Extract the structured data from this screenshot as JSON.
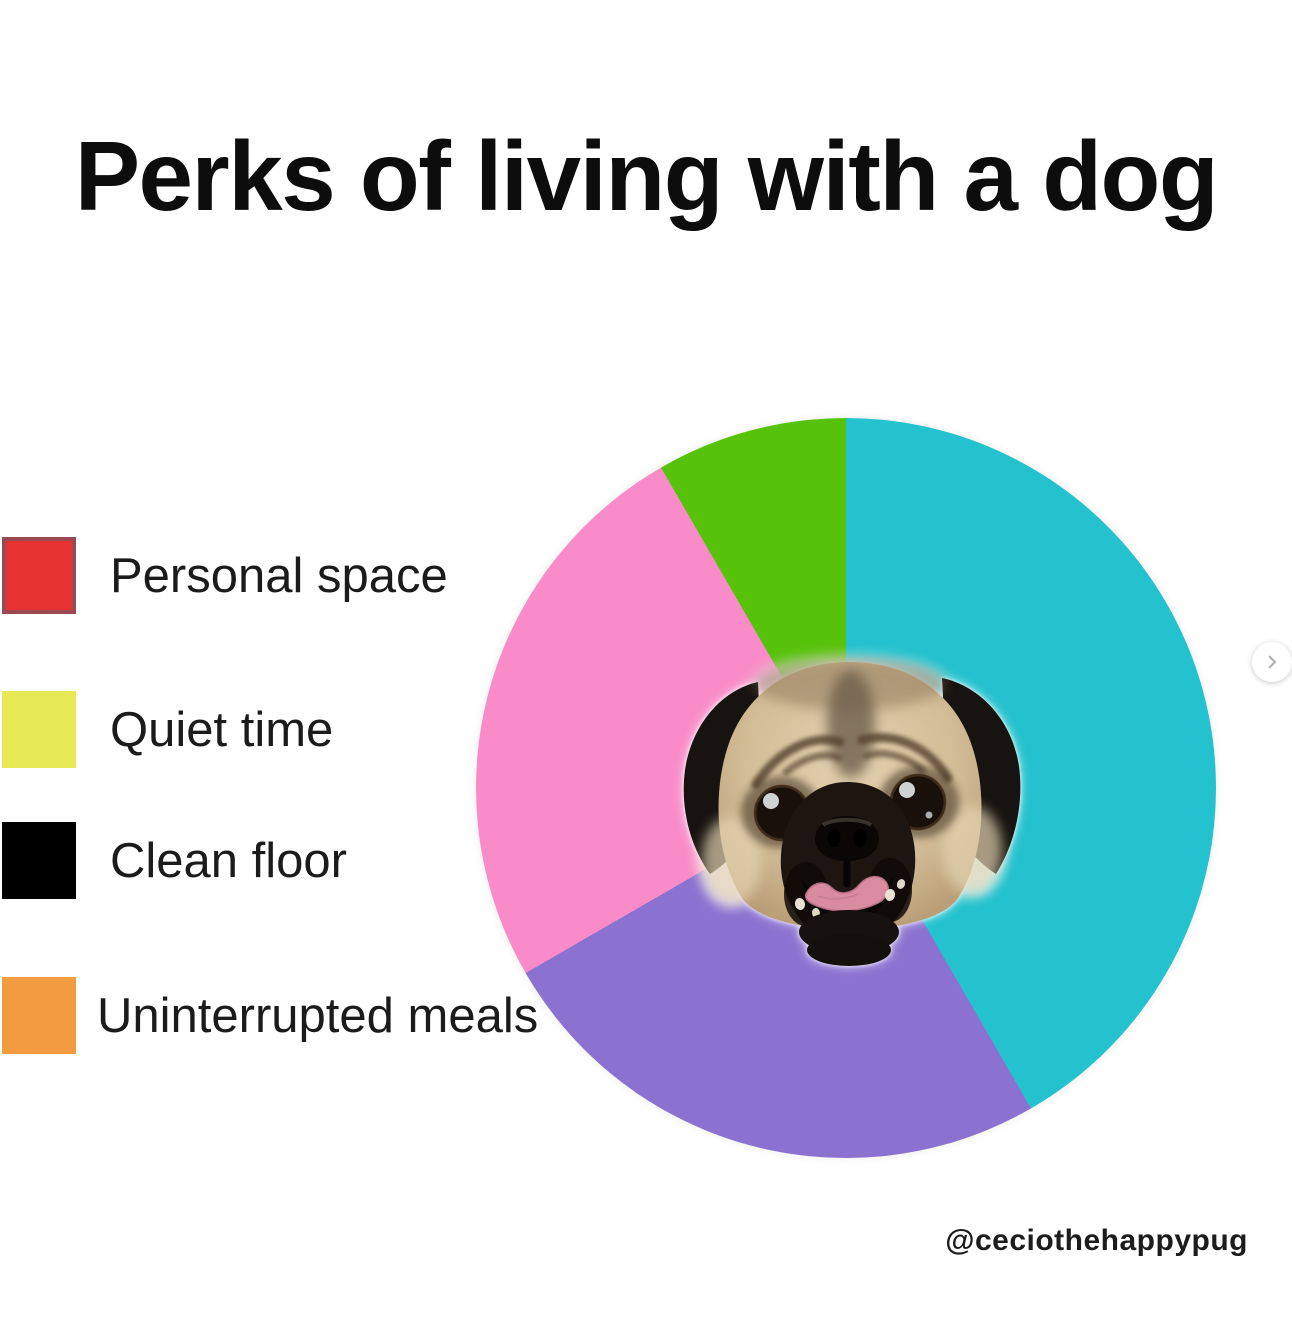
{
  "title": "Perks of living with a dog",
  "legend": {
    "items": [
      {
        "label": "Personal space",
        "color": "#e63230",
        "border": "#9c4a52"
      },
      {
        "label": "Quiet time",
        "color": "#e6e954",
        "border": null
      },
      {
        "label": "Clean floor",
        "color": "#000000",
        "border": null
      },
      {
        "label": "Uninterrupted meals",
        "color": "#f29b41",
        "border": null
      }
    ]
  },
  "chart_data": {
    "type": "pie",
    "title": "Perks of living with a dog",
    "legend_entries": [
      "Personal space",
      "Quiet time",
      "Clean floor",
      "Uninterrupted meals"
    ],
    "legend_colors": [
      "#e63230",
      "#e6e954",
      "#000000",
      "#f29b41"
    ],
    "slices": [
      {
        "name": "teal",
        "hex": "#23c2ce",
        "degrees": 150,
        "percent": 41.7
      },
      {
        "name": "purple",
        "hex": "#8b72d0",
        "degrees": 90,
        "percent": 25
      },
      {
        "name": "pink",
        "hex": "#f98cc8",
        "degrees": 90,
        "percent": 25
      },
      {
        "name": "green",
        "hex": "#57c20a",
        "degrees": 30,
        "percent": 8.3
      }
    ],
    "start_angle_deg": 0,
    "direction": "clockwise",
    "center_image": "pug face photo cutout",
    "annotation": "No pie slice color matches any legend entry color"
  },
  "watermark": "@ceciothehappypug",
  "carousel": {
    "next_icon": "chevron-right",
    "icon_color": "#b3b3b3"
  }
}
